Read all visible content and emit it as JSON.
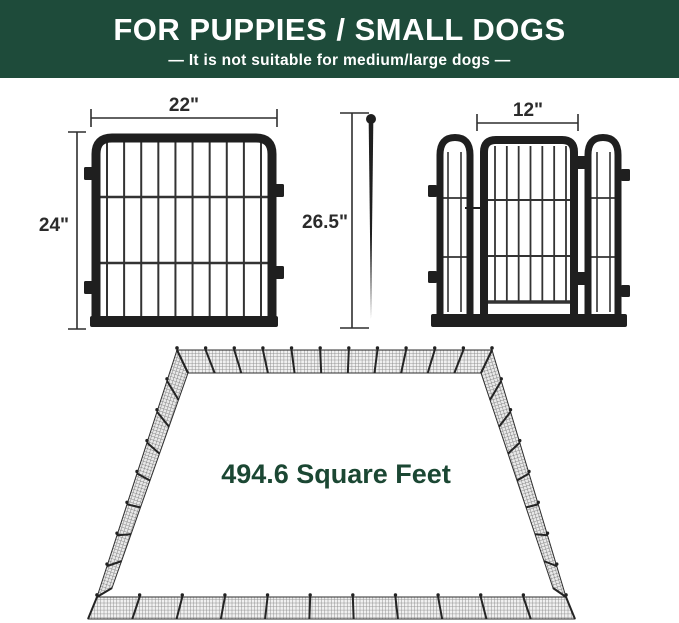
{
  "header": {
    "title": "FOR PUPPIES / SMALL DOGS",
    "subtitle": "—  It is not suitable for medium/large dogs  —"
  },
  "dimensions": {
    "panel_width": "22\"",
    "panel_height": "24\"",
    "overall_height": "26.5\"",
    "door_width": "12\""
  },
  "pen": {
    "area_label": "494.6 Square Feet"
  },
  "colors": {
    "banner_green": "#1e4b3a",
    "area_text_green": "#1b4733",
    "dimension_text": "#2b2b2b",
    "metal_black": "#1f1f1f"
  }
}
